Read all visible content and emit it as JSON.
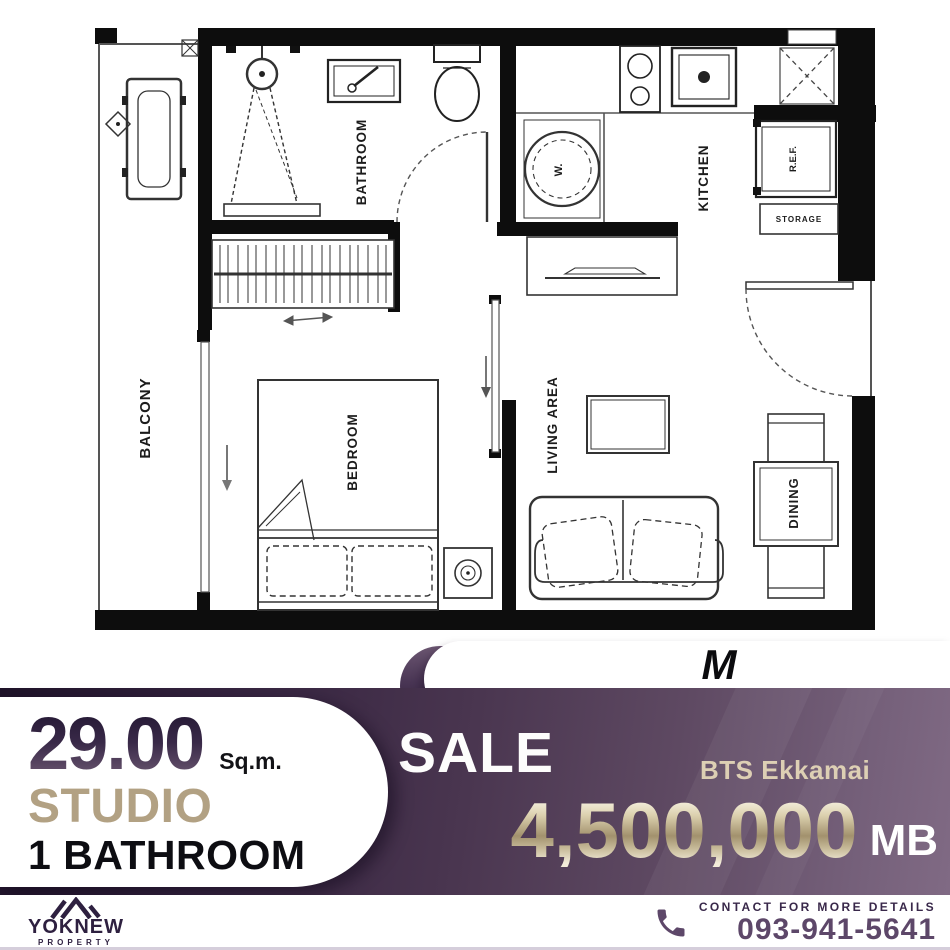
{
  "badge": {
    "model": "M",
    "project": "Thonglor 10"
  },
  "plan": {
    "labels": {
      "balcony": "BALCONY",
      "bathroom": "BATHROOM",
      "kitchen": "KITCHEN",
      "bedroom": "BEDROOM",
      "living": "LIVING AREA",
      "dining": "DINING",
      "fridge": "R.E.F.",
      "storage": "STORAGE",
      "washer": "W."
    }
  },
  "specs": {
    "area": "29.00",
    "area_unit": "Sq.m.",
    "unit_type": "STUDIO",
    "bathroom": "1 BATHROOM"
  },
  "offer": {
    "tag": "SALE",
    "station": "BTS Ekkamai",
    "price": "4,500,000",
    "currency": "MB"
  },
  "footer": {
    "brand": "YOKNEW",
    "brand_sub": "PROPERTY",
    "contact_label": "CONTACT FOR MORE DETAILS",
    "phone": "093-941-5641"
  },
  "colors": {
    "panel_dark": "#241631",
    "panel_light": "#7d667f",
    "gold": "#cfc3a4",
    "tan": "#b2a183",
    "brand_purple": "#5d4769",
    "wall_black": "#0d0d0d"
  }
}
